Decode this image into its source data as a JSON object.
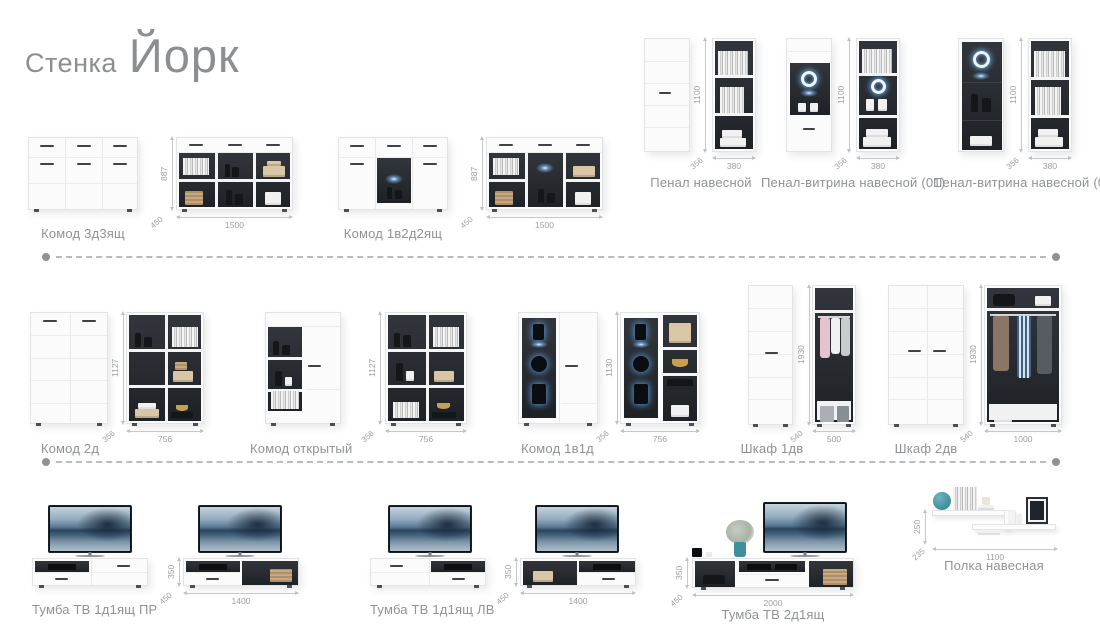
{
  "title": {
    "pre": "Стенка",
    "main": "Йорк"
  },
  "colors": {
    "label_text": "#8f9294",
    "dim_text": "#9ba0a2",
    "led_blue": "#6db5f0",
    "interior_dark": "#282b2e",
    "teal_accent": "#3f8f9e"
  },
  "products": {
    "komod_3d3": {
      "label": "Комод 3д3ящ",
      "height_mm": "887",
      "depth_mm": "450",
      "width_mm": "1500"
    },
    "komod_1v2d2": {
      "label": "Комод 1в2д2ящ",
      "height_mm": "887",
      "depth_mm": "450",
      "width_mm": "1500"
    },
    "penal": {
      "label": "Пенал навесной",
      "height_mm": "1100",
      "depth_mm": "356",
      "width_mm": "380"
    },
    "penal_v1": {
      "label": "Пенал-витрина навесной (01)",
      "height_mm": "1100",
      "depth_mm": "356",
      "width_mm": "380"
    },
    "penal_v2": {
      "label": "Пенал-витрина навесной (02)",
      "height_mm": "1100",
      "depth_mm": "356",
      "width_mm": "380"
    },
    "komod_2d": {
      "label": "Комод 2д",
      "height_mm": "1127",
      "depth_mm": "356",
      "width_mm": "756"
    },
    "komod_otkryty": {
      "label": "Комод открытый",
      "height_mm": "1127",
      "depth_mm": "356",
      "width_mm": "756"
    },
    "komod_1v1d": {
      "label": "Комод 1в1д",
      "height_mm": "1130",
      "depth_mm": "356",
      "width_mm": "756"
    },
    "shkaf_1dv": {
      "label": "Шкаф 1дв",
      "height_mm": "1930",
      "depth_mm": "540",
      "width_mm": "500"
    },
    "shkaf_2dv": {
      "label": "Шкаф 2дв",
      "height_mm": "1930",
      "depth_mm": "540",
      "width_mm": "1000"
    },
    "tumba_tv_pr": {
      "label": "Тумба ТВ 1д1ящ ПР",
      "height_mm": "350",
      "depth_mm": "450",
      "width_mm": "1400"
    },
    "tumba_tv_lv": {
      "label": "Тумба ТВ 1д1ящ ЛВ",
      "height_mm": "350",
      "depth_mm": "450",
      "width_mm": "1400"
    },
    "tumba_tv_2d": {
      "label": "Тумба ТВ 2д1ящ",
      "height_mm": "350",
      "depth_mm": "450",
      "width_mm": "2000"
    },
    "polka": {
      "label": "Полка навесная",
      "height_mm": "250",
      "depth_mm": "235",
      "width_mm": "1100"
    }
  }
}
